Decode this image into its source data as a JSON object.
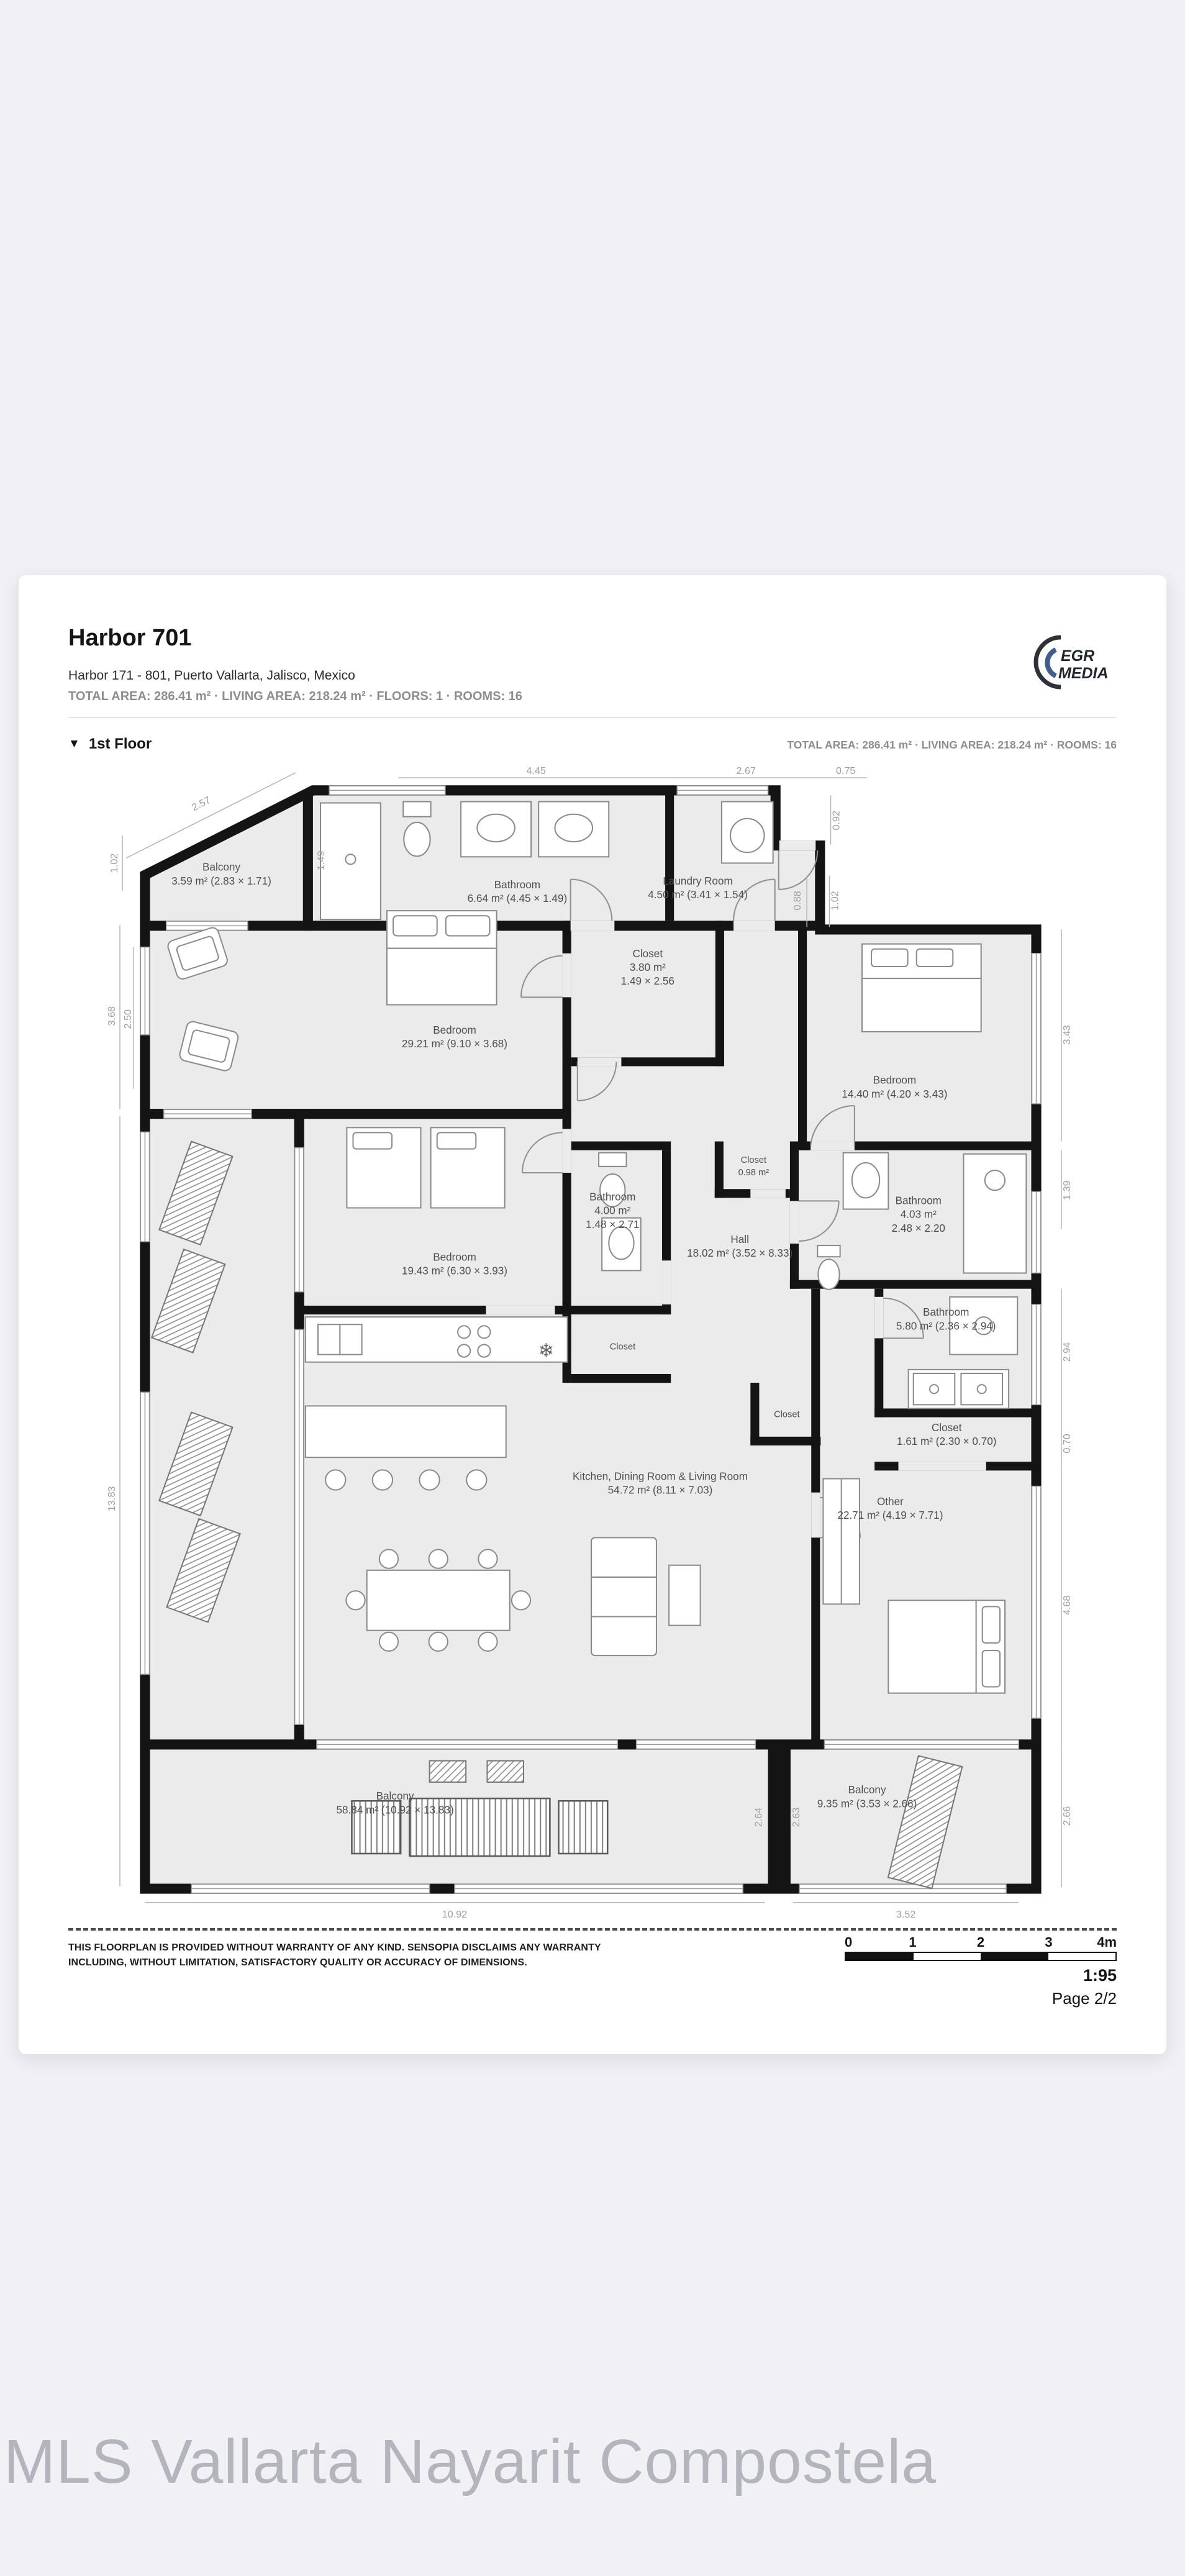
{
  "page": {
    "background": "#f1f0f5",
    "watermark": "MLS Vallarta Nayarit Compostela"
  },
  "header": {
    "title": "Harbor 701",
    "address": "Harbor 171 - 801,  Puerto Vallarta, Jalisco, Mexico",
    "meta": "TOTAL AREA: 286.41 m² · LIVING AREA: 218.24 m² · FLOORS: 1 · ROOMS: 16",
    "logo": {
      "line1": "EGR",
      "line2": "MEDIA"
    }
  },
  "floor_section": {
    "expander_icon": "▼",
    "title": "1st Floor",
    "meta": "TOTAL AREA: 286.41 m² · LIVING AREA: 218.24 m² · ROOMS: 16"
  },
  "floorplan": {
    "rooms": {
      "balcony_tl": {
        "name": "Balcony",
        "line2": "3.59 m² (2.83 × 1.71)"
      },
      "bathroom_top": {
        "name": "Bathroom",
        "line2": "6.64 m² (4.45 × 1.49)"
      },
      "laundry": {
        "name": "Laundry Room",
        "line2": "4.50 m² (3.41 × 1.54)"
      },
      "closet_380": {
        "name": "Closet",
        "line2": "3.80 m²",
        "line3": "1.49 × 2.56"
      },
      "bedroom_29": {
        "name": "Bedroom",
        "line2": "29.21 m² (9.10 × 3.68)"
      },
      "bedroom_14": {
        "name": "Bedroom",
        "line2": "14.40 m² (4.20 × 3.43)"
      },
      "closet_098": {
        "name": "Closet",
        "line2": "0.98 m²"
      },
      "bathroom_403": {
        "name": "Bathroom",
        "line2": "4.03 m²",
        "line3": "2.48 × 2.20"
      },
      "hall": {
        "name": "Hall",
        "line2": "18.02 m² (3.52 × 8.33)"
      },
      "bathroom_400": {
        "name": "Bathroom",
        "line2": "4.00 m²",
        "line3": "1.48 × 2.71"
      },
      "bedroom_19": {
        "name": "Bedroom",
        "line2": "19.43 m² (6.30 × 3.93)"
      },
      "bathroom_580": {
        "name": "Bathroom",
        "line2": "5.80 m² (2.36 × 2.94)"
      },
      "closet_161": {
        "name": "Closet",
        "line2": "1.61 m² (2.30 × 0.70)"
      },
      "other": {
        "name": "Other",
        "line2": "22.71 m² (4.19 × 7.71)"
      },
      "kitchen": {
        "name": "Kitchen, Dining Room & Living Room",
        "line2": "54.72 m² (8.11 × 7.03)"
      },
      "closet_a": {
        "name": "Closet"
      },
      "closet_b": {
        "name": "Closet"
      },
      "balcony_main": {
        "name": "Balcony",
        "line2": "58.84 m² (10.92 × 13.83)"
      },
      "balcony_right": {
        "name": "Balcony",
        "line2": "9.35 m² (3.53 × 2.66)"
      }
    },
    "dims": {
      "top": [
        "2.57",
        "4.45",
        "2.67",
        "0.75"
      ],
      "left": [
        "1.02",
        "3.68",
        "2.50",
        "13.83"
      ],
      "right": [
        "0.92",
        "0.88",
        "1.02",
        "3.43",
        "1.39",
        "2.94",
        "0.70",
        "4.68",
        "2.66"
      ],
      "bottom": [
        "10.92",
        "3.52"
      ],
      "inner": [
        "1.49",
        "2.64",
        "2.63"
      ]
    },
    "colors": {
      "wall": "#141414",
      "room_fill": "#ebebeb",
      "dim_text": "#9e9e9e"
    }
  },
  "footer": {
    "disclaimer_line1": "THIS FLOORPLAN IS PROVIDED WITHOUT WARRANTY OF ANY KIND. SENSOPIA DISCLAIMS ANY WARRANTY",
    "disclaimer_line2": "INCLUDING, WITHOUT LIMITATION, SATISFACTORY QUALITY OR ACCURACY OF DIMENSIONS.",
    "scale_ticks": [
      "0",
      "1",
      "2",
      "3",
      "4m"
    ],
    "scale_ratio": "1:95",
    "page": "Page 2/2"
  }
}
